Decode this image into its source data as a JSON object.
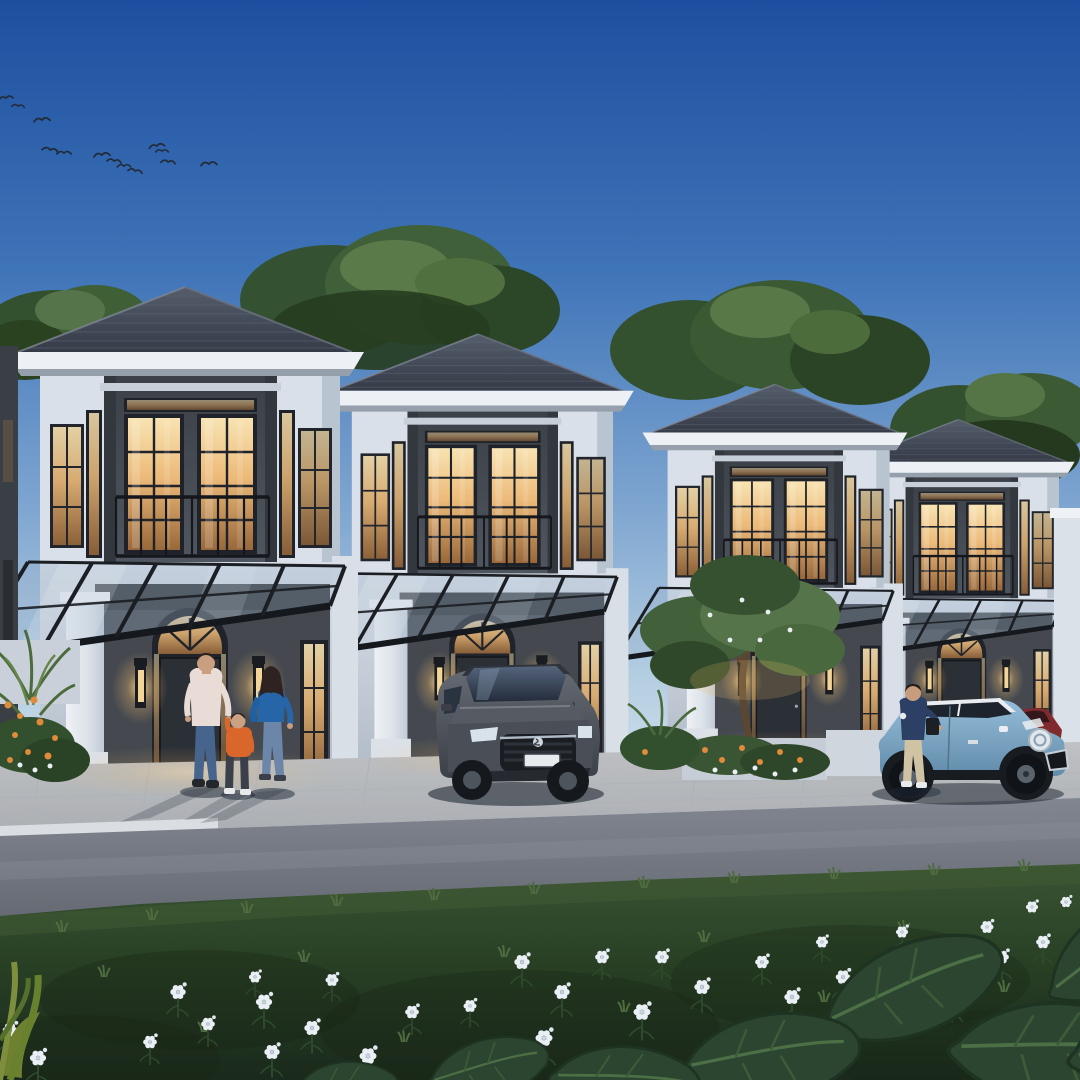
{
  "scene": {
    "setting": "row of four modern two-storey tropical houses at dusk",
    "houses_count": 4,
    "time_of_day": "dusk",
    "foreground": "asphalt road and lawn with white flowers and large leaves",
    "figures": "family of three walking at house one, man beside hatchback at house four",
    "vehicles": "grey SUV in carport, light blue hatchback with white roof, dark red car partly hidden"
  },
  "palette": {
    "sky_top": "#1c4f9f",
    "sky_horizon": "#e7f0f5",
    "roof": "#3c4450",
    "fascia_white": "#edf0f4",
    "facade_white": "#dde4ec",
    "facade_dark": "#45494f",
    "window_glow": "#ecba79",
    "canopy_frame": "#1b1e23",
    "pavement": "#cdd0d4",
    "asphalt": "#666b76",
    "lawn": "#2f4a2b",
    "tree_green": "#3f6038",
    "flower_white": "#e9eff4",
    "suv_body": "#565b63",
    "hatchback_body": "#8db6d2",
    "hatchback_roof": "#e9edf1",
    "red_car": "#7e2a2e",
    "dad_sweater": "#e9dcd6",
    "kid_sweater": "#d9662b",
    "mom_top": "#2565a8",
    "man_polo": "#2c4066",
    "jeans": "#47648c"
  },
  "houses": [
    {
      "id": "house-4",
      "tx": 838,
      "ty": 233,
      "scale": 0.65
    },
    {
      "id": "house-3",
      "tx": 638,
      "ty": 172,
      "scale": 0.74
    },
    {
      "id": "house-2",
      "tx": 317,
      "ty": 84.5,
      "scale": 0.87
    },
    {
      "id": "house-1",
      "tx": 0,
      "ty": 0,
      "scale": 1
    }
  ],
  "birds": [
    [
      6,
      99,
      0.9,
      -8
    ],
    [
      18,
      107,
      0.8,
      5
    ],
    [
      42,
      121,
      1.0,
      -5
    ],
    [
      50,
      151,
      1.0,
      10
    ],
    [
      64,
      154,
      0.9,
      0
    ],
    [
      102,
      156,
      1.0,
      -6
    ],
    [
      114,
      162,
      0.9,
      8
    ],
    [
      124,
      167,
      0.85,
      0
    ],
    [
      135,
      172,
      0.9,
      12
    ],
    [
      157,
      147,
      0.95,
      -10
    ],
    [
      162,
      152,
      0.8,
      0
    ],
    [
      168,
      163,
      0.9,
      6
    ],
    [
      209,
      165,
      1.0,
      -4
    ]
  ],
  "flowers": [
    [
      10,
      1030,
      0.9
    ],
    [
      38,
      1058,
      1.0
    ],
    [
      150,
      1042,
      0.85
    ],
    [
      178,
      992,
      0.95
    ],
    [
      208,
      1024,
      0.85
    ],
    [
      255,
      977,
      0.75
    ],
    [
      264,
      1002,
      1.0
    ],
    [
      272,
      1052,
      0.95
    ],
    [
      312,
      1028,
      0.95
    ],
    [
      332,
      980,
      0.8
    ],
    [
      368,
      1056,
      1.05
    ],
    [
      412,
      1012,
      0.85
    ],
    [
      470,
      1006,
      0.8
    ],
    [
      492,
      1066,
      1.15
    ],
    [
      522,
      962,
      0.95
    ],
    [
      544,
      1038,
      1.05
    ],
    [
      562,
      992,
      0.95
    ],
    [
      602,
      957,
      0.85
    ],
    [
      642,
      1012,
      1.05
    ],
    [
      662,
      957,
      0.85
    ],
    [
      702,
      987,
      0.95
    ],
    [
      732,
      1042,
      1.1
    ],
    [
      762,
      962,
      0.85
    ],
    [
      792,
      997,
      0.95
    ],
    [
      822,
      942,
      0.75
    ],
    [
      843,
      977,
      0.9
    ],
    [
      868,
      1007,
      0.95
    ],
    [
      902,
      932,
      0.75
    ],
    [
      922,
      962,
      0.85
    ],
    [
      952,
      997,
      0.95
    ],
    [
      987,
      927,
      0.8
    ],
    [
      1002,
      957,
      0.85
    ],
    [
      1032,
      907,
      0.75
    ],
    [
      1043,
      942,
      0.85
    ],
    [
      1066,
      902,
      0.7
    ],
    [
      1071,
      967,
      0.85
    ]
  ],
  "tufts": [
    [
      60,
      932
    ],
    [
      150,
      920
    ],
    [
      245,
      913
    ],
    [
      335,
      906
    ],
    [
      432,
      900
    ],
    [
      532,
      894
    ],
    [
      642,
      888
    ],
    [
      732,
      883
    ],
    [
      832,
      879
    ],
    [
      932,
      875
    ],
    [
      1022,
      871
    ],
    [
      102,
      977
    ],
    [
      302,
      962
    ],
    [
      502,
      957
    ],
    [
      702,
      942
    ],
    [
      902,
      932
    ],
    [
      202,
      1032
    ],
    [
      402,
      1042
    ],
    [
      622,
      1012
    ],
    [
      822,
      1002
    ],
    [
      1002,
      992
    ]
  ],
  "leaves": [
    [
      828,
      1016,
      1.7,
      -18
    ],
    [
      958,
      1042,
      1.9,
      6
    ],
    [
      1052,
      986,
      1.5,
      -30
    ],
    [
      1075,
      1052,
      1.8,
      -8
    ],
    [
      688,
      1062,
      1.6,
      -4
    ],
    [
      556,
      1072,
      1.35,
      8
    ],
    [
      432,
      1078,
      1.1,
      -10
    ],
    [
      302,
      1082,
      0.9,
      4
    ]
  ],
  "glows": [
    [
      190,
      772,
      150,
      26,
      0.45
    ],
    [
      482,
      758,
      120,
      22,
      0.4
    ],
    [
      778,
      748,
      95,
      18,
      0.35
    ],
    [
      962,
      740,
      80,
      15,
      0.3
    ]
  ]
}
